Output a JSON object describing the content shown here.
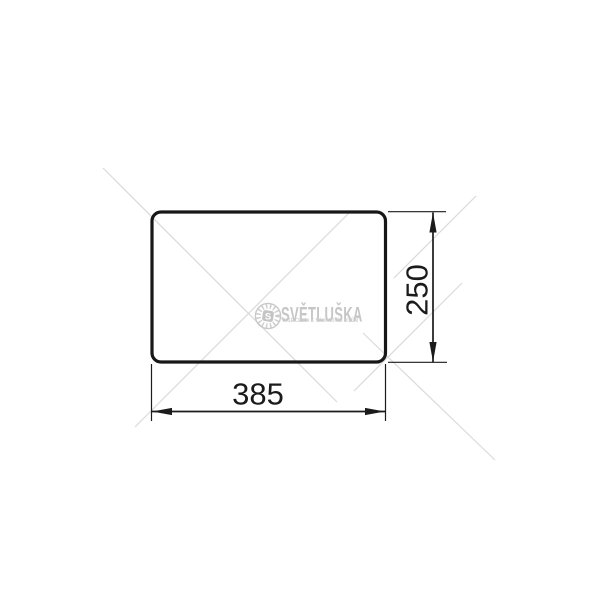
{
  "page": {
    "background_color": "#ffffff"
  },
  "drawing": {
    "description": "rounded-rectangle panel outline with two linear dimensions",
    "stroke_color": "#171717",
    "dimensions": {
      "width": {
        "value": "385"
      },
      "height": {
        "value": "250"
      }
    }
  },
  "watermark": {
    "logo_letter": "S",
    "brand": "SVĚTLUŠKA",
    "tagline": "VAŠE CESTA K NÁHRADNÍM DÍLŮM",
    "text_color": "#c6c6c6",
    "line_color": "#dadada"
  }
}
